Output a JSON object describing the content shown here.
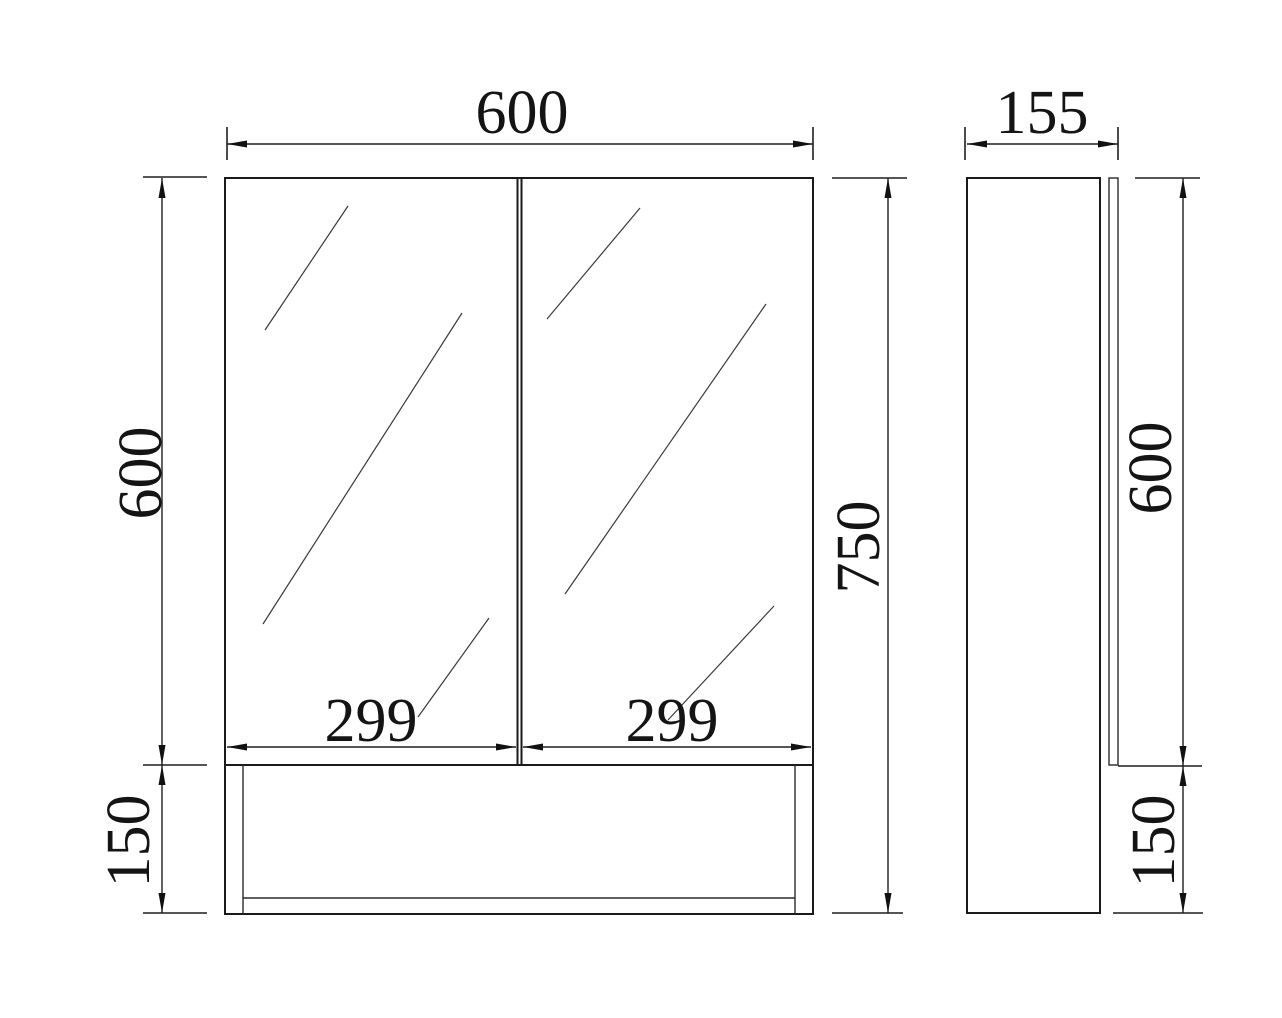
{
  "drawing": {
    "type": "technical-dimension-drawing",
    "subject": "mirror-cabinet",
    "views": [
      {
        "id": "front-view",
        "description": "front elevation with two mirrored doors and open shelf below"
      },
      {
        "id": "side-view",
        "description": "side profile showing cabinet depth and door panel"
      }
    ]
  },
  "colors": {
    "ink": "#1a1a1a",
    "background": "#ffffff"
  },
  "dimensions": [
    {
      "id": "front-overall-width",
      "text": "600",
      "orientation": "horizontal"
    },
    {
      "id": "side-depth",
      "text": "155",
      "orientation": "horizontal"
    },
    {
      "id": "front-mirror-height",
      "text": "600",
      "orientation": "vertical"
    },
    {
      "id": "front-overall-height",
      "text": "750",
      "orientation": "vertical"
    },
    {
      "id": "side-mirror-height",
      "text": "600",
      "orientation": "vertical"
    },
    {
      "id": "left-door-width",
      "text": "299",
      "orientation": "horizontal"
    },
    {
      "id": "right-door-width",
      "text": "299",
      "orientation": "horizontal"
    },
    {
      "id": "front-shelf-height",
      "text": "150",
      "orientation": "vertical"
    },
    {
      "id": "side-shelf-height",
      "text": "150",
      "orientation": "vertical"
    }
  ]
}
